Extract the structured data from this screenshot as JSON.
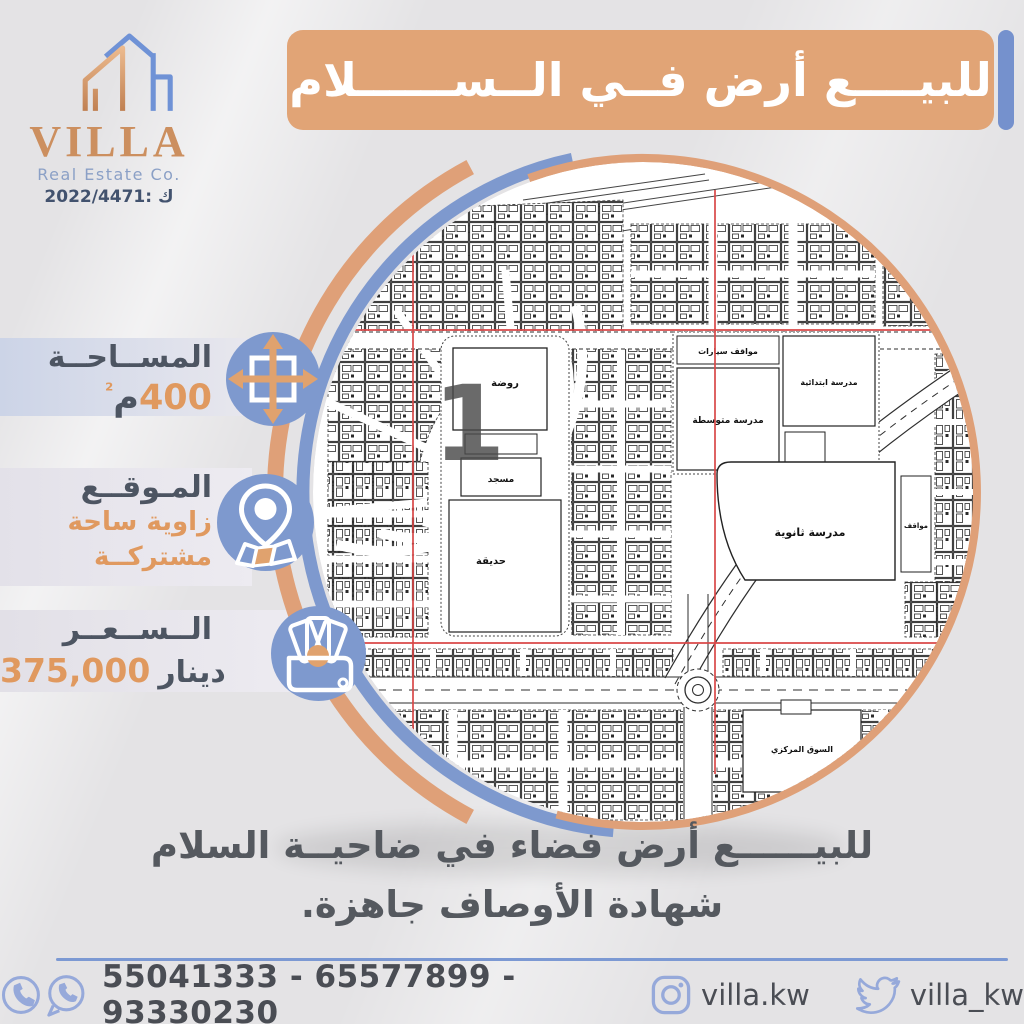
{
  "logo": {
    "brand": "VILLA",
    "subtitle": "Real Estate Co.",
    "license": "2022/4471: ك"
  },
  "banner": {
    "title": "للبيــــع أرض فــي الــســــــلام"
  },
  "info": {
    "area": {
      "label": "المســاحــة",
      "number": "400",
      "unit": "م",
      "sup": "²"
    },
    "location": {
      "label": "المـوقــع",
      "line1": "زاوية ساحة",
      "line2": "مشتركــة"
    },
    "price": {
      "label": "الــســعــر",
      "amount": "375,000",
      "currency": "دينار"
    }
  },
  "map": {
    "marker": "1",
    "labels": {
      "kindergarten": "روضة",
      "mosque": "مسجد",
      "park": "حديقة",
      "car_parking": "مواقف سيارات",
      "middle_school": "مدرسة متوسطة",
      "elementary_school": "مدرسة ابتدائية",
      "high_school": "مدرسة ثانوية",
      "parking": "مواقف",
      "central_market": "السوق المركزي"
    }
  },
  "tagline": {
    "line1": "للبيــــــع أرض فضاء في ضاحيــة السلام",
    "line2": "شهادة الأوصاف جاهزة."
  },
  "footer": {
    "phones": "55041333 - 65577899 - 93330230",
    "instagram": "villa.kw",
    "twitter": "villa_kw"
  },
  "colors": {
    "accent_orange": "#e0a273",
    "accent_blue": "#7e99ce",
    "text_dark": "#4d5562",
    "text_orange": "#e0995f",
    "map_red": "#d94848",
    "footer_blue": "#96a9da",
    "banner_bar_blue": "#7591cd"
  }
}
